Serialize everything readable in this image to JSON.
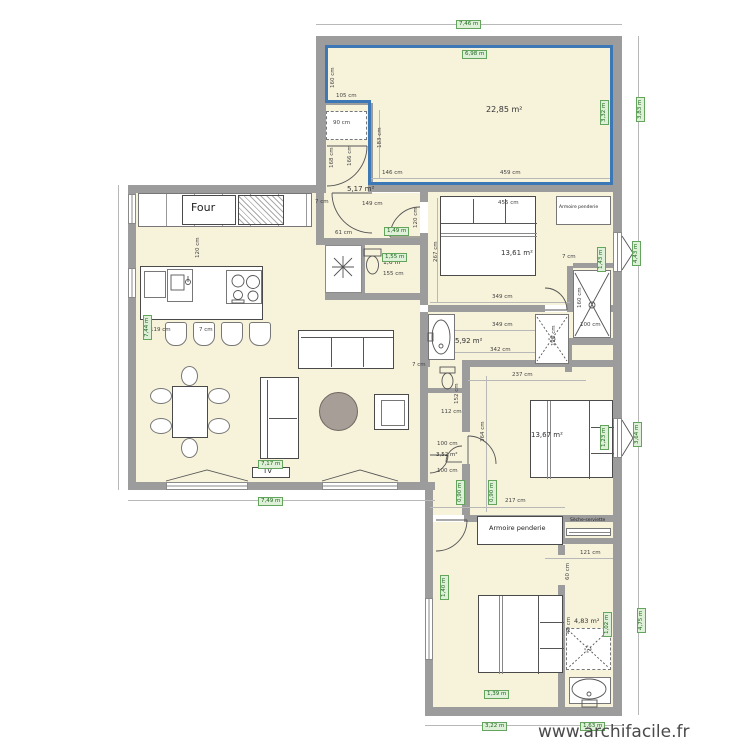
{
  "watermark": "www.archifacile.fr",
  "colors": {
    "room_fill": "#f7f2da",
    "wall": "#9c9c9c",
    "selection_blue": "#3d78b6",
    "dim_label_bg": "#dff0d8",
    "dim_label_border": "#63a55c",
    "dim_label_text": "#1c661c",
    "rug": "#a79e98"
  },
  "labels": {
    "areas": [
      {
        "t": "22,85 m²",
        "x": 486,
        "y": 106,
        "fs": 8
      },
      {
        "t": "5,17 m²",
        "x": 347,
        "y": 186
      },
      {
        "t": "1,6 m²",
        "x": 383,
        "y": 260,
        "fs": 6
      },
      {
        "t": "13,61 m²",
        "x": 501,
        "y": 250
      },
      {
        "t": "5,92 m²",
        "x": 455,
        "y": 338
      },
      {
        "t": "13,67 m²",
        "x": 531,
        "y": 432
      },
      {
        "t": "3,52 m²",
        "x": 436,
        "y": 453,
        "fs": 5.5
      },
      {
        "t": "4,83 m²",
        "x": 574,
        "y": 618,
        "fs": 6.5
      }
    ],
    "dims": [
      {
        "t": "160 cm",
        "x": 331,
        "y": 88,
        "v": true
      },
      {
        "t": "105 cm",
        "x": 336,
        "y": 94
      },
      {
        "t": "183 cm",
        "x": 378,
        "y": 148,
        "v": true
      },
      {
        "t": "146 cm",
        "x": 382,
        "y": 171
      },
      {
        "t": "459 cm",
        "x": 500,
        "y": 171
      },
      {
        "t": "90 cm",
        "x": 333,
        "y": 121
      },
      {
        "t": "168 cm",
        "x": 330,
        "y": 168,
        "v": true
      },
      {
        "t": "166 cm",
        "x": 348,
        "y": 166,
        "v": true
      },
      {
        "t": "7 cm",
        "x": 315,
        "y": 200
      },
      {
        "t": "149 cm",
        "x": 362,
        "y": 202
      },
      {
        "t": "120 cm",
        "x": 414,
        "y": 228,
        "v": true
      },
      {
        "t": "61 cm",
        "x": 335,
        "y": 231
      },
      {
        "t": "120 cm",
        "x": 196,
        "y": 258,
        "v": true
      },
      {
        "t": "119 cm",
        "x": 150,
        "y": 328
      },
      {
        "t": "7 cm",
        "x": 199,
        "y": 328
      },
      {
        "t": "155 cm",
        "x": 383,
        "y": 272
      },
      {
        "t": "455 cm",
        "x": 498,
        "y": 201
      },
      {
        "t": "267 cm",
        "x": 434,
        "y": 262,
        "v": true
      },
      {
        "t": "7 cm",
        "x": 562,
        "y": 255
      },
      {
        "t": "349 cm",
        "x": 492,
        "y": 295
      },
      {
        "t": "160 cm",
        "x": 578,
        "y": 308,
        "v": true
      },
      {
        "t": "100 cm",
        "x": 580,
        "y": 323
      },
      {
        "t": "349 cm",
        "x": 492,
        "y": 323
      },
      {
        "t": "342 cm",
        "x": 490,
        "y": 348
      },
      {
        "t": "120 cm",
        "x": 552,
        "y": 346,
        "v": true
      },
      {
        "t": "237 cm",
        "x": 512,
        "y": 373
      },
      {
        "t": "364 cm",
        "x": 481,
        "y": 442,
        "v": true
      },
      {
        "t": "217 cm",
        "x": 505,
        "y": 499
      },
      {
        "t": "112 cm",
        "x": 441,
        "y": 410
      },
      {
        "t": "152 cm",
        "x": 455,
        "y": 404,
        "v": true
      },
      {
        "t": "100 cm",
        "x": 437,
        "y": 442
      },
      {
        "t": "100 cm",
        "x": 437,
        "y": 469
      },
      {
        "t": "7 cm",
        "x": 412,
        "y": 363
      },
      {
        "t": "121 cm",
        "x": 580,
        "y": 551
      },
      {
        "t": "40 cm",
        "x": 567,
        "y": 634,
        "v": true
      },
      {
        "t": "60 cm",
        "x": 566,
        "y": 580,
        "v": true
      }
    ],
    "wall_lengths": [
      {
        "t": "7,46 m",
        "x": 456,
        "y": 20
      },
      {
        "t": "6,98 m",
        "x": 462,
        "y": 50
      },
      {
        "t": "3,32 m",
        "x": 600,
        "y": 125,
        "v": true
      },
      {
        "t": "3,83 m",
        "x": 636,
        "y": 122,
        "v": true
      },
      {
        "t": "1,43 m",
        "x": 597,
        "y": 272,
        "v": true
      },
      {
        "t": "4,43 m",
        "x": 632,
        "y": 266,
        "v": true
      },
      {
        "t": "1,49 m",
        "x": 384,
        "y": 227
      },
      {
        "t": "1,55 m",
        "x": 382,
        "y": 253
      },
      {
        "t": "7,44 m",
        "x": 143,
        "y": 340,
        "v": true
      },
      {
        "t": "7,17 m",
        "x": 258,
        "y": 460
      },
      {
        "t": "7,49 m",
        "x": 258,
        "y": 497
      },
      {
        "t": "0,90 m",
        "x": 456,
        "y": 505,
        "v": true
      },
      {
        "t": "0,90 m",
        "x": 488,
        "y": 505,
        "v": true
      },
      {
        "t": "1,23 m",
        "x": 600,
        "y": 450,
        "v": true
      },
      {
        "t": "3,64 m",
        "x": 633,
        "y": 447,
        "v": true
      },
      {
        "t": "1,40 m",
        "x": 440,
        "y": 600,
        "v": true
      },
      {
        "t": "1,02 m",
        "x": 603,
        "y": 637,
        "v": true
      },
      {
        "t": "4,75 m",
        "x": 637,
        "y": 633,
        "v": true
      },
      {
        "t": "1,39 m",
        "x": 484,
        "y": 690
      },
      {
        "t": "3,22 m",
        "x": 482,
        "y": 722
      },
      {
        "t": "1,63 m",
        "x": 580,
        "y": 722
      }
    ],
    "furniture": [
      {
        "t": "Four",
        "x": 191,
        "y": 202,
        "fs": 11
      },
      {
        "t": "TV",
        "x": 263,
        "y": 468,
        "fs": 7
      },
      {
        "t": "Armoire penderie",
        "x": 559,
        "y": 206,
        "fs": 4.5
      },
      {
        "t": "Armoire penderie",
        "x": 489,
        "y": 525,
        "fs": 6.5
      },
      {
        "t": "Sèche-serviette",
        "x": 570,
        "y": 519,
        "fs": 4.5
      }
    ]
  }
}
